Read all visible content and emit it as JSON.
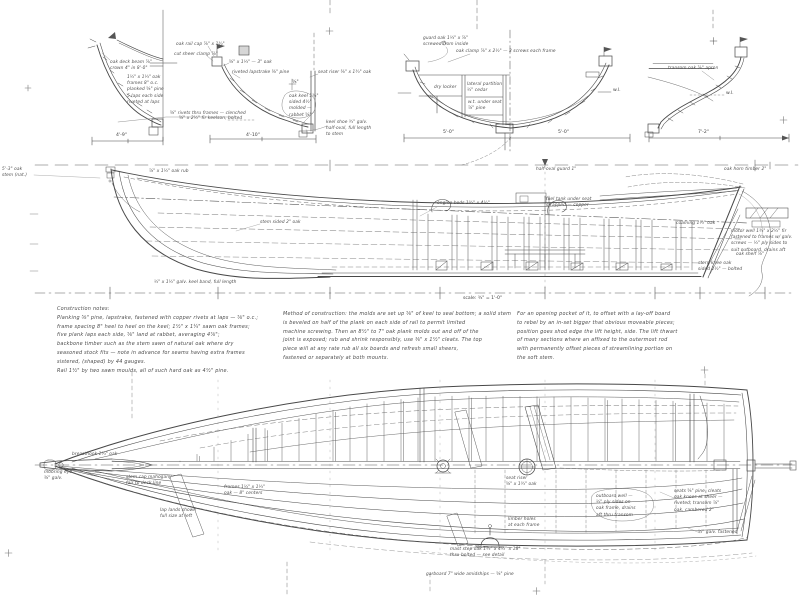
{
  "colors": {
    "paper": "#ffffff",
    "ink": "#484848",
    "pencil": "#777777"
  },
  "annotations": {
    "s1_a1": "oak deck beam ⅞\"\ncrown 4\" in 8'-0\"",
    "s1_a2": "1½\" x 1¼\" oak\nframes 8\" o.c.\nplanked ⅝\" pine\n5 laps each side\nriveted at laps",
    "s1_a3": "⅝\" rivets thru frames — clenched",
    "s1_dim": "4'-9\"",
    "s2_b1": "oak rail cap ⅞\" x 1¾\"",
    "s2_b2": "cut sheer clamp ⅞\"",
    "s2_b3": "⅝\" x 1¼\" — 3\" oak",
    "s2_b4": "riveted lapstrake ⅝\" pine",
    "s2_b5": "seat riser ⅝\" x 1¾\" oak",
    "s2_b6": "⅝\"",
    "s2_b7": "oak keel 1¾\"\nsided 4½\"\nmolded —\nrabbet ⅝\"",
    "s2_b8": "keel shoe ¾\" galv.\nhalf-oval, full length\nto stem",
    "s2_b9": "⅝\" x 2½\" fir keelson, bolted",
    "s2_dim": "4'-10\"",
    "s3_c1": "guard oak 1¼\" x ⅞\"\nscrewed from inside",
    "s3_c2": "oak clamp ⅞\" x 2½\" — 3 screws each frame",
    "s3_c3": "dry locker",
    "s3_c4": "lateral partition\n½\" cedar",
    "s3_c5": "w.t. under seat\n⅞\" pine",
    "s3_wl": "w.l.",
    "s3_dim_l": "5'-0\"",
    "s3_dim_r": "5'-0\"",
    "s4_d1": "transom oak ⅞\" apron",
    "s4_wl": "w.l.",
    "s4_dim": "7'-2\"",
    "pf_stem": "5'-3\" oak\nstem (nat.)",
    "pf_rub": "⅞\" x 1½\" oak rub",
    "pf_skeg": "stem sided 2\" oak",
    "pf_beds": "engine beds 1¾\" x 4½\"",
    "pf_tank": "fuel tank under seat\nstrapped — copper",
    "pf_guard": "half-oval guard 1\"",
    "pf_horn": "oak horn timber 2\"",
    "pf_coaming": "coaming 1¼\" oak",
    "pf_well": "motor well 1¾\" x 2½\" fir\nfastened to frames w/ galv.\nscrews — ½\" ply sides to\nsuit outboard, drains aft",
    "pf_shelf": "oak shelf ⅞\"",
    "pf_knee": "stern knee oak\nsided 2½\" — bolted",
    "pf_keelband": "½\" x 1½\" galv. keel band, full length",
    "pf_scale": "scale: ¾\" = 1'-0\"",
    "pl_breasthook": "breasthook 1¾\" oak",
    "pl_eye": "mooring eye\n⅜\" galv.",
    "pl_stemcap": "stem cap mahogany\nfair to deck line",
    "pl_frames": "frames 1½\" x 1¼\"\noak — 8\" centers",
    "pl_riser": "seat riser\n⅝\" x 1¾\" oak",
    "pl_maststep": "mast step oak 1¾\" x 4½\" x 18\"\nthru-bolted — see detail",
    "pl_well": "outboard well —\n½\" ply sides on\noak frame, drains\naft thru transom",
    "pl_seats": "seats ⅝\" pine, cleats\noak knees at sheer —\nriveted; transom ⅞\"\noak, cambered 2\"",
    "pl_galv": "½\" galv. fastened",
    "pl_limber": "limber holes\nat each frame",
    "pl_garboard": "garboard 7\" wide amidships — ⅝\" pine",
    "pl_laps": "lap lands shown\nfull size at left"
  },
  "notes": {
    "col1": "Construction notes:\nPlanking ⅝\" pine, lapstrake, fastened with copper rivets at laps — ⅝\" o.c.;\nframe spacing 8\" heel to heel on the keel; 1½\" x 1¼\" sawn oak frames;\nfive plank laps each side, ⅝\" land at rabbet, averaging 4⅞\";\nbackbone timber such as the stem sawn of natural oak where dry\nseasoned stock fits — note in advance for seams having extra frames\nsistered, (shaped) by 44 gauges.\nRail 1½\" by two sawn moulds, all of such hard oak as 4½\" pine.",
    "col2": "Method of construction: the molds are set up ⅝\" of keel to seal bottom; a solid stem\nis beveled on half of the plank on each side of rail to permit limited\nmachine screwing. Then an 8½\" to 7\" oak plank molds out and off of the\njoint is exposed; rub and shrink responsibly, use ⅜\" x 1½\" cleats. The top\npiece will at any rate rub all six boards and refresh small sheers,\nfastened or separately at both mounts.",
    "col3": "For an opening pocket of it, to offset with a lay-off board\nto rebel by an in-set bigger that obvious moveable pieces;\nposition goes shod edge the lift height, side. The lift thwart\nof many sections where an affixed to the outermost rod\nwith permanently offset pieces of streamlining portion on\nthe soft stem."
  }
}
